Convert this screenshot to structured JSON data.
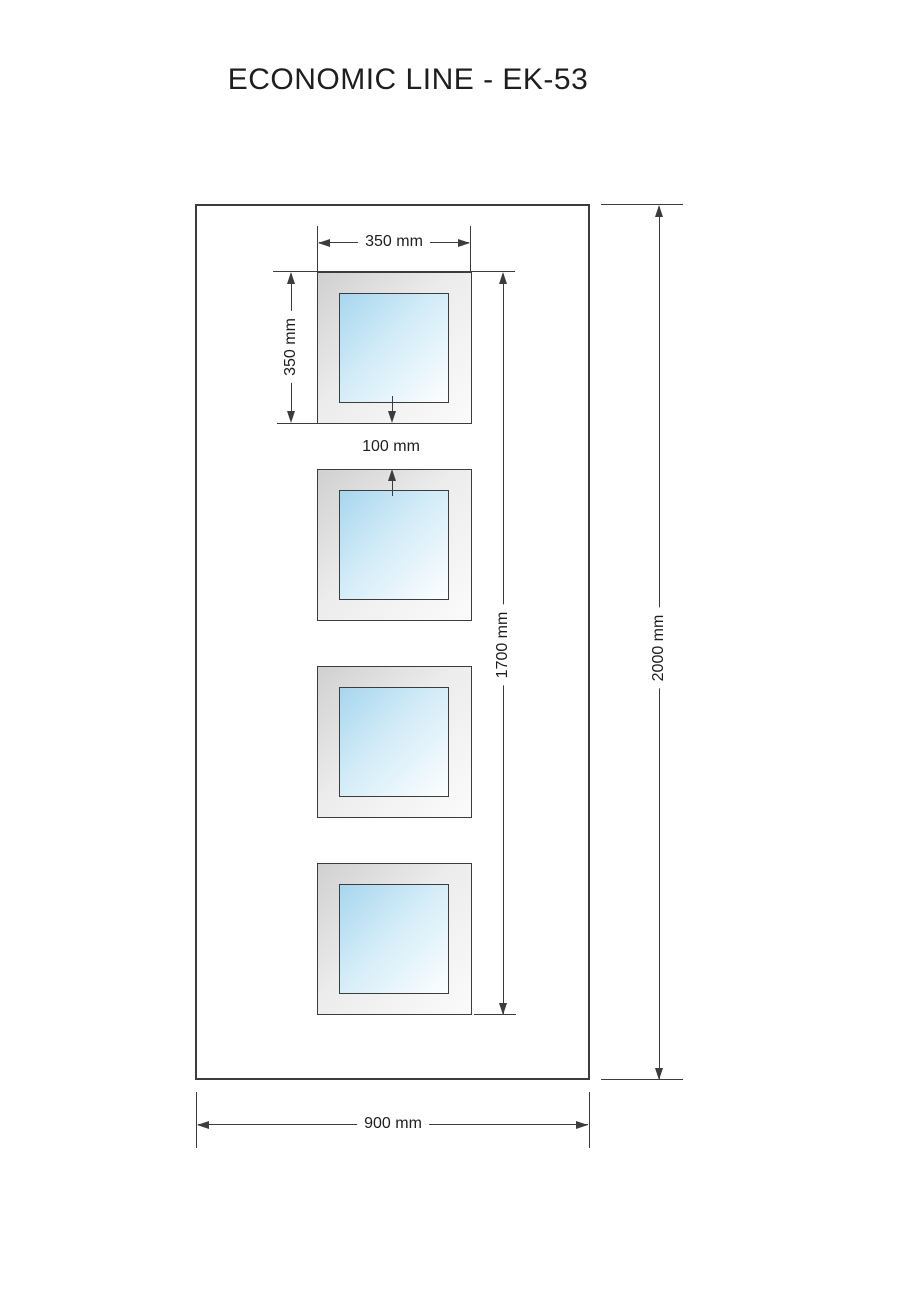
{
  "title": "ECONOMIC LINE - EK-53",
  "drawing": {
    "labels": {
      "window_width": "350 mm",
      "window_height": "350 mm",
      "gap": "100 mm",
      "glazing_span": "1700 mm",
      "door_height": "2000 mm",
      "door_width": "900 mm"
    },
    "window_count": 4,
    "colors": {
      "line": "#3c3c3c",
      "text": "#1e1e1e",
      "frame_gradient_start": "#d0d0d0",
      "frame_gradient_end": "#fbfbfb",
      "glass_gradient_start": "#a7d6ee",
      "glass_gradient_end": "#fdfeff",
      "background": "#ffffff"
    }
  }
}
